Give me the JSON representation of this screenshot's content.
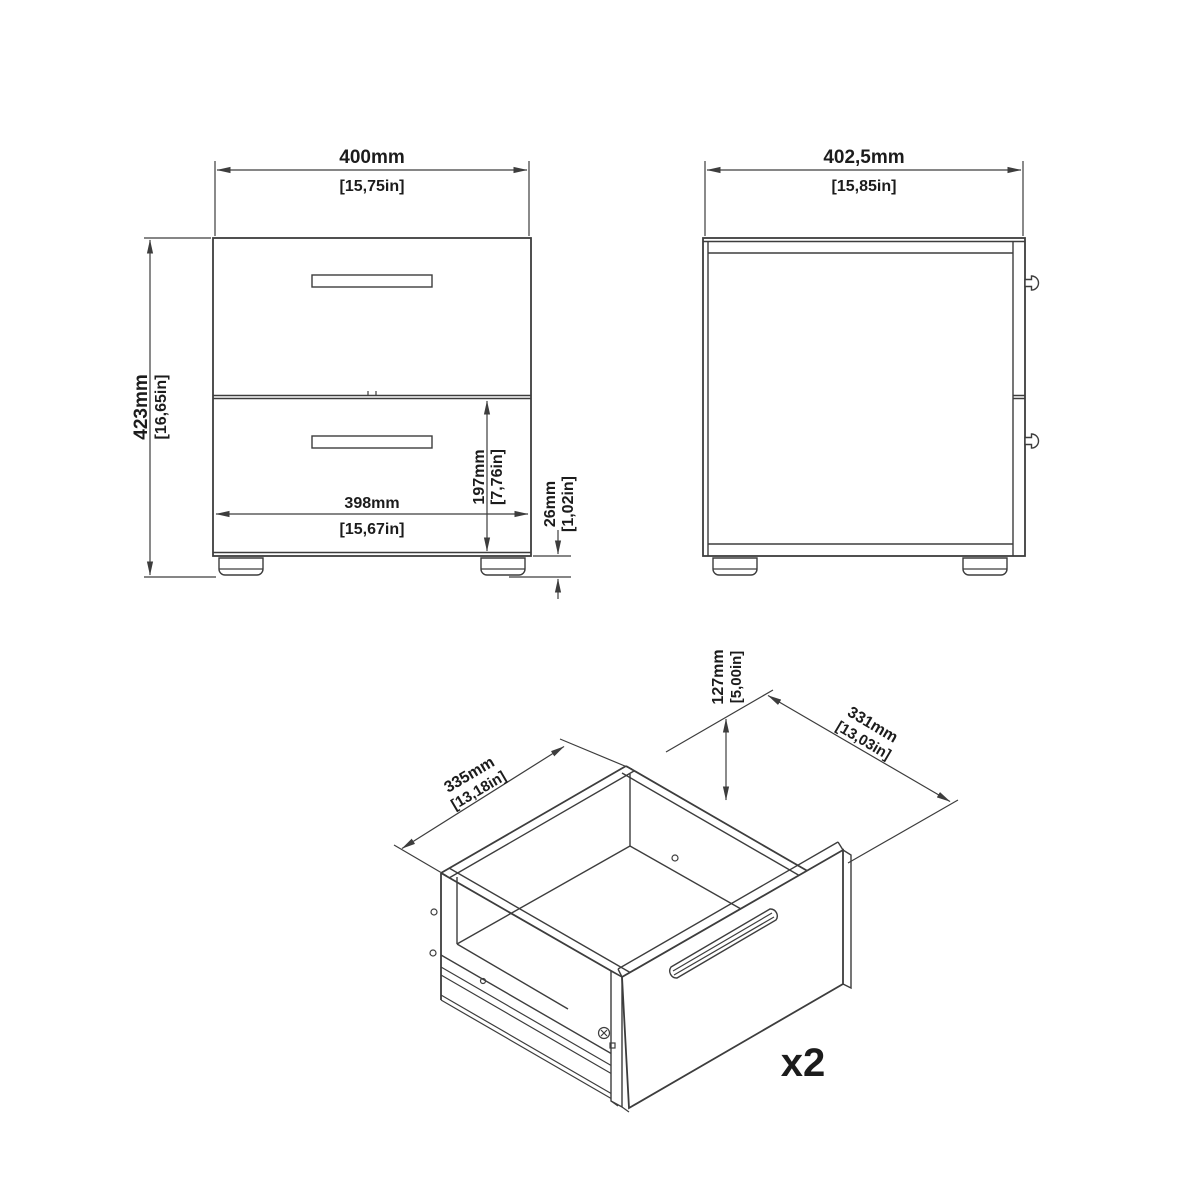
{
  "diagram": {
    "background": "#ffffff",
    "line_color": "#3d3d3d",
    "text_color": "#1c1c1c",
    "front_view": {
      "dim_width_mm": "400mm",
      "dim_width_in": "[15,75in]",
      "dim_height_mm": "423mm",
      "dim_height_in": "[16,65in]",
      "dim_inner_width_mm": "398mm",
      "dim_inner_width_in": "[15,67in]",
      "dim_drawer_mm": "197mm",
      "dim_drawer_in": "[7,76in]",
      "dim_foot_mm": "26mm",
      "dim_foot_in": "[1,02in]"
    },
    "side_view": {
      "dim_depth_mm": "402,5mm",
      "dim_depth_in": "[15,85in]"
    },
    "drawer_view": {
      "dim_side_mm": "335mm",
      "dim_side_in": "[13,18in]",
      "dim_width_mm": "331mm",
      "dim_width_in": "[13,03in]",
      "dim_height_mm": "127mm",
      "dim_height_in": "[5,00in]",
      "quantity": "x2"
    }
  }
}
